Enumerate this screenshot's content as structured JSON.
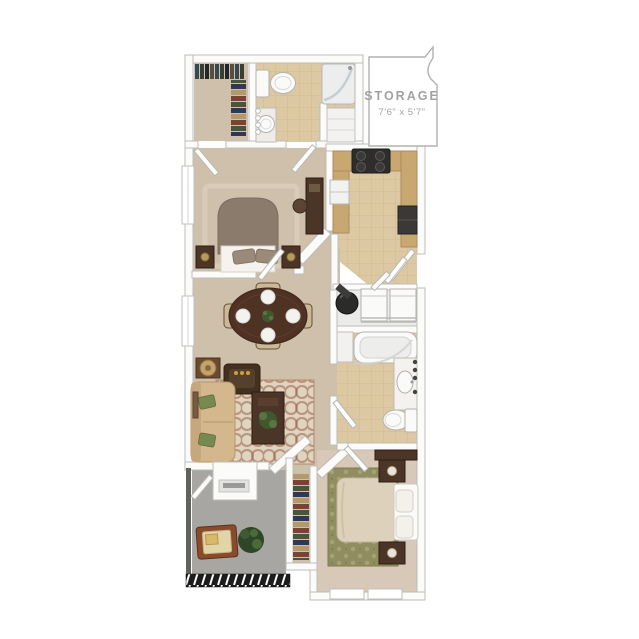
{
  "canvas": {
    "width": 639,
    "height": 639,
    "background": "#ffffff"
  },
  "storage_room": {
    "label": "STORAGE",
    "dimensions": "7'6\" x 5'7\""
  },
  "colors": {
    "wall_fill": "#fbfbf9",
    "wall_line": "#bdbcba",
    "carpet": "#cfc0ac",
    "carpet_bedroom2": "#d8c8b7",
    "tile": "#dcc8a2",
    "tile_line": "#cdb68c",
    "patio_floor": "#a7a6a3",
    "storage_text": "#a2a2a2",
    "wood_dark": "#4b3526",
    "wood_mid": "#6b4a33",
    "sofa_tan": "#d4b78c",
    "rug_cream": "#ded4c0",
    "rug_accent": "#9c5c48",
    "rug_olive": "#908d60",
    "bedding_cream": "#ddd1bc",
    "headboard_taupe": "#8b7b6c",
    "appliance_black": "#2e2d2b",
    "counter_tan": "#c8a771",
    "cabinet_gray": "#9b9a97",
    "plant_green": "#41582f",
    "pillow_green": "#78894f",
    "fixture_white": "#fafaf8",
    "railing_dark": "#1c1c1c"
  }
}
